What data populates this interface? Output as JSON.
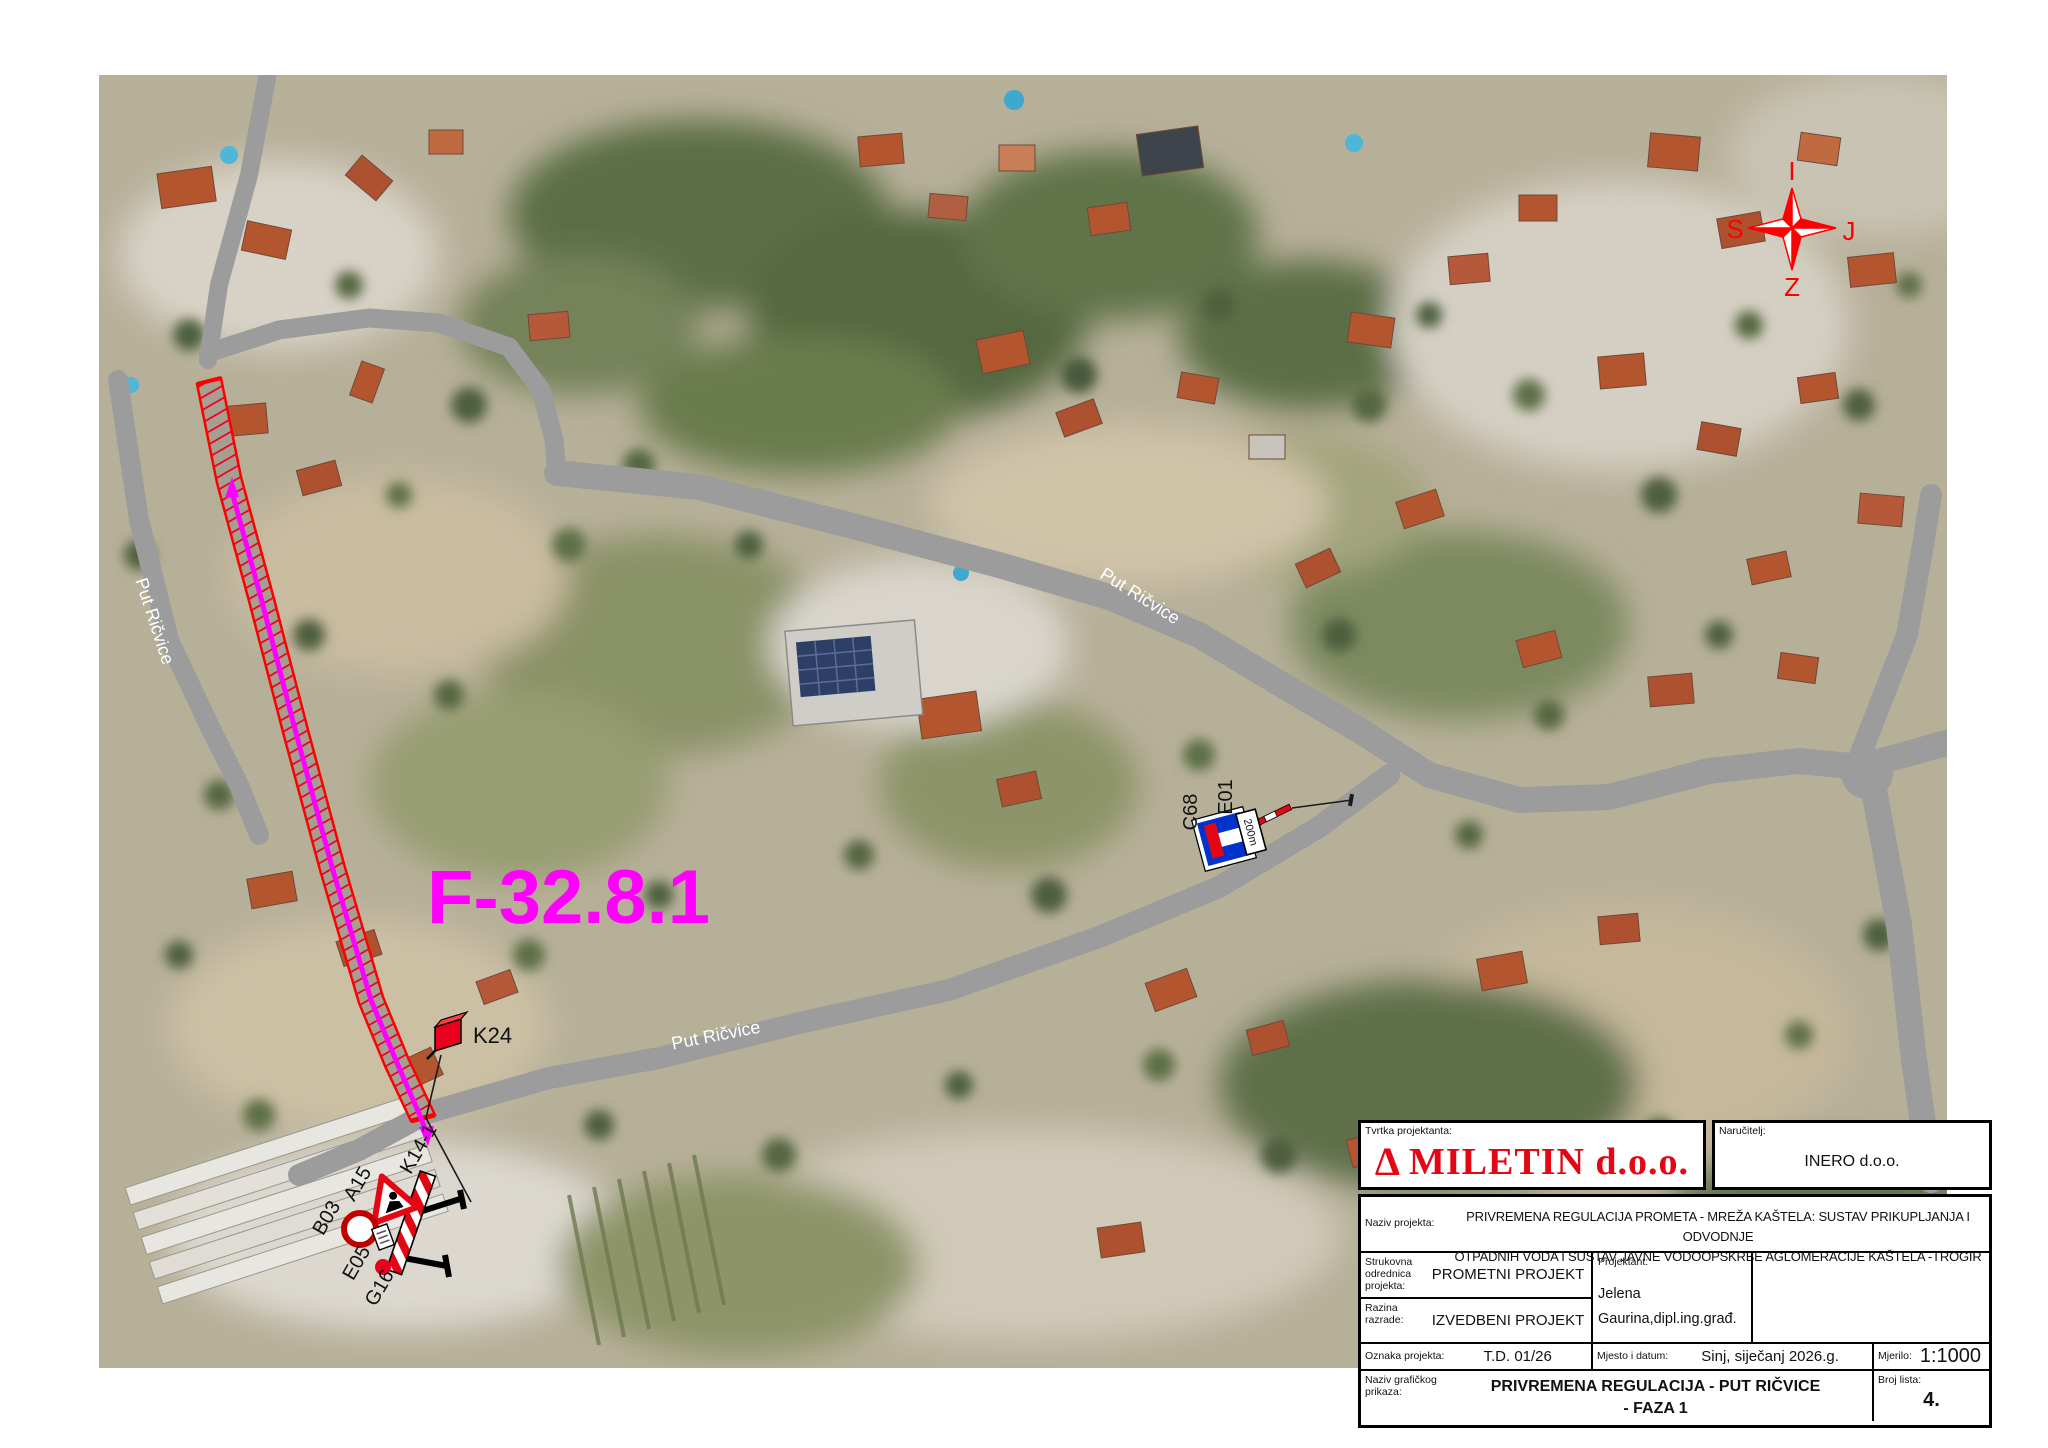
{
  "map": {
    "zone_label": "F-32.8.1",
    "road_name": "Put Ričvice",
    "compass": {
      "top": "I",
      "right": "J",
      "bottom": "Z",
      "left": "S"
    },
    "signs": {
      "k24": "K24",
      "k14": "K14-1",
      "a15": "A15",
      "b03": "B03",
      "e05": "E05",
      "g16": "G16",
      "c68": "C68",
      "e01": "E01",
      "panel_200m": "200m"
    }
  },
  "title_block": {
    "tvrtka_label": "Tvrtka projektanta:",
    "logo_delta": "Δ",
    "logo_name": "MILETIN d.o.o.",
    "narucitelj_label": "Naručitelj:",
    "narucitelj_value": "INERO d.o.o.",
    "naziv_projekta_label": "Naziv projekta:",
    "naziv_projekta_line1": "PRIVREMENA REGULACIJA PROMETA - MREŽA KAŠTELA: SUSTAV PRIKUPLJANJA I ODVODNJE",
    "naziv_projekta_line2": "OTPADNIH VODA I SUSTAV JAVNE VODOOPSKRBE AGLOMERACIJE KAŠTELA -TROGIR",
    "strukovna_label": "Strukovna odrednica projekta:",
    "strukovna_value": "PROMETNI PROJEKT",
    "razina_label": "Razina razrade:",
    "razina_value": "IZVEDBENI PROJEKT",
    "projektant_label": "Projektant:",
    "projektant_line1": "Jelena",
    "projektant_line2": "Gaurina,dipl.ing.građ.",
    "oznaka_label": "Oznaka projekta:",
    "oznaka_value": "T.D.  01/26",
    "mjesto_label": "Mjesto i datum:",
    "mjesto_value": "Sinj, siječanj 2026.g.",
    "mjerilo_label": "Mjerilo:",
    "mjerilo_value": "1:1000",
    "naziv_graf_label": "Naziv grafičkog prikaza:",
    "naziv_graf_line1": "PRIVREMENA REGULACIJA - PUT RIČVICE",
    "naziv_graf_line2": "- FAZA 1",
    "broj_lista_label": "Broj lista:",
    "broj_lista_value": "4."
  },
  "colors": {
    "work_zone_red": "#ff0000",
    "centerline_magenta": "#ff00ff",
    "zone_label_magenta": "#ff00ff",
    "road_gray": "#9c9c9c",
    "logo_red": "#e30613",
    "compass_red": "#ff0000",
    "dead_end_sign_blue": "#0033cc"
  }
}
